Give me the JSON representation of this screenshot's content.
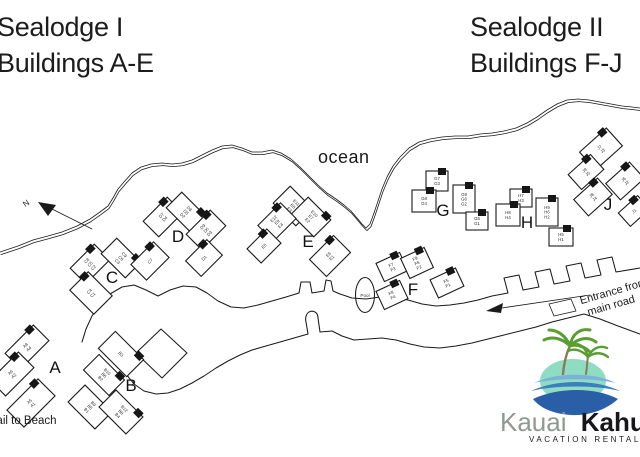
{
  "page": {
    "background": "#ffffff",
    "line_color": "#1a1a1a"
  },
  "titles": {
    "left_line1": "Sealodge I",
    "left_line2": "Buildings A-E",
    "right_line1": "Sealodge II",
    "right_line2": "Buildings F-J"
  },
  "map_labels": {
    "ocean": "ocean",
    "pool": "Pool",
    "north": "N",
    "trail_to_beach": "Trail to Beach",
    "entrance_line1": "Entrance from",
    "entrance_line2": "main road"
  },
  "logo": {
    "brand_first": "Kauai",
    "brand_second": "Kahuna",
    "tagline": "Vacation Rentals",
    "colors": {
      "palm_green": "#5a9e32",
      "trunk_brown": "#8a7a55",
      "island_teal": "#8edcc2",
      "wave_dark": "#2a5fa8",
      "wave_mid": "#3c7fc0",
      "wave_light": "#7ab1dd",
      "brand_first_color": "#8d9a8d",
      "brand_second_color": "#17171b",
      "tagline_color": "#76a240"
    }
  },
  "buildings": [
    {
      "letter": "A",
      "label_x": 55,
      "label_y": 373,
      "wings": [
        {
          "x": 27,
          "y": 347,
          "w": 40,
          "h": 22,
          "r": -45,
          "units": [
            "A8",
            "A4"
          ]
        },
        {
          "x": 12,
          "y": 374,
          "w": 40,
          "h": 22,
          "r": -45,
          "units": [
            "A6",
            "A2"
          ]
        },
        {
          "x": 31,
          "y": 403,
          "w": 44,
          "h": 24,
          "r": -45,
          "units": [
            "A5",
            "A1"
          ]
        }
      ]
    },
    {
      "letter": "B",
      "label_x": 131,
      "label_y": 391,
      "wings": [
        {
          "x": 121,
          "y": 354,
          "w": 40,
          "h": 24,
          "r": 45,
          "units": [
            "B3"
          ]
        },
        {
          "x": 104,
          "y": 375,
          "w": 36,
          "h": 22,
          "r": 45,
          "units": [
            "B10",
            "B6",
            "B2"
          ]
        },
        {
          "x": 90,
          "y": 407,
          "w": 38,
          "h": 24,
          "r": 45,
          "units": [
            "B9",
            "B5",
            "B1"
          ]
        },
        {
          "x": 121,
          "y": 412,
          "w": 38,
          "h": 24,
          "r": 45,
          "units": [
            "B12",
            "B8",
            "B4"
          ]
        }
      ]
    },
    {
      "letter": "C",
      "label_x": 112,
      "label_y": 283,
      "wings": [
        {
          "x": 90,
          "y": 264,
          "w": 34,
          "h": 22,
          "r": -45,
          "units": [
            "C8",
            "C5",
            "C2"
          ]
        },
        {
          "x": 121,
          "y": 258,
          "w": 34,
          "h": 22,
          "r": 45,
          "units": [
            "C9",
            "C6",
            "C3"
          ]
        },
        {
          "x": 150,
          "y": 261,
          "w": 32,
          "h": 22,
          "r": -45,
          "units": [
            "C7"
          ]
        },
        {
          "x": 91,
          "y": 293,
          "w": 26,
          "h": 34,
          "r": -45,
          "units": [
            "C4",
            "C1"
          ]
        }
      ]
    },
    {
      "letter": "D",
      "label_x": 178,
      "label_y": 242,
      "wings": [
        {
          "x": 163,
          "y": 217,
          "w": 34,
          "h": 22,
          "r": -45,
          "units": [
            "D7",
            "D4"
          ]
        },
        {
          "x": 186,
          "y": 212,
          "w": 34,
          "h": 22,
          "r": 45,
          "units": [
            "D8",
            "D5",
            "D2"
          ]
        },
        {
          "x": 206,
          "y": 230,
          "w": 34,
          "h": 22,
          "r": -45,
          "units": [
            "D9",
            "D6",
            "D3"
          ]
        },
        {
          "x": 204,
          "y": 258,
          "w": 30,
          "h": 22,
          "r": -45,
          "units": [
            "D1"
          ]
        }
      ]
    },
    {
      "letter": "E",
      "label_x": 308,
      "label_y": 247,
      "wings": [
        {
          "x": 293,
          "y": 206,
          "w": 32,
          "h": 24,
          "r": 45,
          "units": [
            "E11",
            "E8",
            "E3"
          ]
        },
        {
          "x": 311,
          "y": 217,
          "w": 32,
          "h": 24,
          "r": 45,
          "units": [
            "E10",
            "E7",
            "E2"
          ]
        },
        {
          "x": 277,
          "y": 222,
          "w": 32,
          "h": 22,
          "r": -45,
          "units": [
            "E12",
            "E9",
            "E4"
          ]
        },
        {
          "x": 264,
          "y": 246,
          "w": 28,
          "h": 20,
          "r": -45,
          "units": [
            "E5"
          ]
        },
        {
          "x": 330,
          "y": 256,
          "w": 34,
          "h": 24,
          "r": -45,
          "units": [
            "E6",
            "E1"
          ]
        }
      ]
    },
    {
      "letter": "F",
      "label_x": 413,
      "label_y": 295,
      "wings": [
        {
          "x": 392,
          "y": 267,
          "w": 26,
          "h": 20,
          "r": -25,
          "units": [
            "F7",
            "F3"
          ]
        },
        {
          "x": 417,
          "y": 263,
          "w": 26,
          "h": 22,
          "r": -25,
          "units": [
            "F9",
            "F6",
            "F2"
          ]
        },
        {
          "x": 392,
          "y": 295,
          "w": 26,
          "h": 20,
          "r": -25,
          "units": [
            "F8",
            "F4"
          ]
        },
        {
          "x": 447,
          "y": 283,
          "w": 28,
          "h": 20,
          "r": -25,
          "units": [
            "F5",
            "F1"
          ]
        }
      ]
    },
    {
      "letter": "G",
      "label_x": 443,
      "label_y": 216,
      "wings": [
        {
          "x": 437,
          "y": 181,
          "w": 22,
          "h": 20,
          "r": 0,
          "units": [
            "G7",
            "G3"
          ]
        },
        {
          "x": 424,
          "y": 201,
          "w": 24,
          "h": 22,
          "r": 0,
          "units": [
            "G8",
            "G4"
          ]
        },
        {
          "x": 464,
          "y": 199,
          "w": 22,
          "h": 28,
          "r": 0,
          "units": [
            "G9",
            "G6",
            "G2"
          ]
        },
        {
          "x": 477,
          "y": 221,
          "w": 22,
          "h": 18,
          "r": 0,
          "units": [
            "G5",
            "G1"
          ]
        }
      ]
    },
    {
      "letter": "H",
      "label_x": 527,
      "label_y": 228,
      "wings": [
        {
          "x": 521,
          "y": 198,
          "w": 22,
          "h": 18,
          "r": 0,
          "units": [
            "H7",
            "H3"
          ]
        },
        {
          "x": 508,
          "y": 215,
          "w": 24,
          "h": 22,
          "r": 0,
          "units": [
            "H8",
            "H4"
          ]
        },
        {
          "x": 547,
          "y": 212,
          "w": 22,
          "h": 28,
          "r": 0,
          "units": [
            "H9",
            "H6",
            "H2"
          ]
        },
        {
          "x": 561,
          "y": 237,
          "w": 24,
          "h": 18,
          "r": 0,
          "units": [
            "H5",
            "H1"
          ]
        }
      ]
    },
    {
      "letter": "J",
      "label_x": 608,
      "label_y": 210,
      "wings": [
        {
          "x": 601,
          "y": 149,
          "w": 36,
          "h": 24,
          "r": -42,
          "units": [
            "J7",
            "J3"
          ]
        },
        {
          "x": 586,
          "y": 172,
          "w": 30,
          "h": 20,
          "r": -42,
          "units": [
            "J9",
            "J5"
          ]
        },
        {
          "x": 593,
          "y": 197,
          "w": 32,
          "h": 22,
          "r": -42,
          "units": [
            "J8",
            "J4"
          ]
        },
        {
          "x": 625,
          "y": 181,
          "w": 32,
          "h": 22,
          "r": -42,
          "units": [
            "J6",
            "J2"
          ]
        },
        {
          "x": 634,
          "y": 211,
          "w": 26,
          "h": 18,
          "r": -42,
          "units": [
            "J1"
          ]
        }
      ]
    }
  ]
}
